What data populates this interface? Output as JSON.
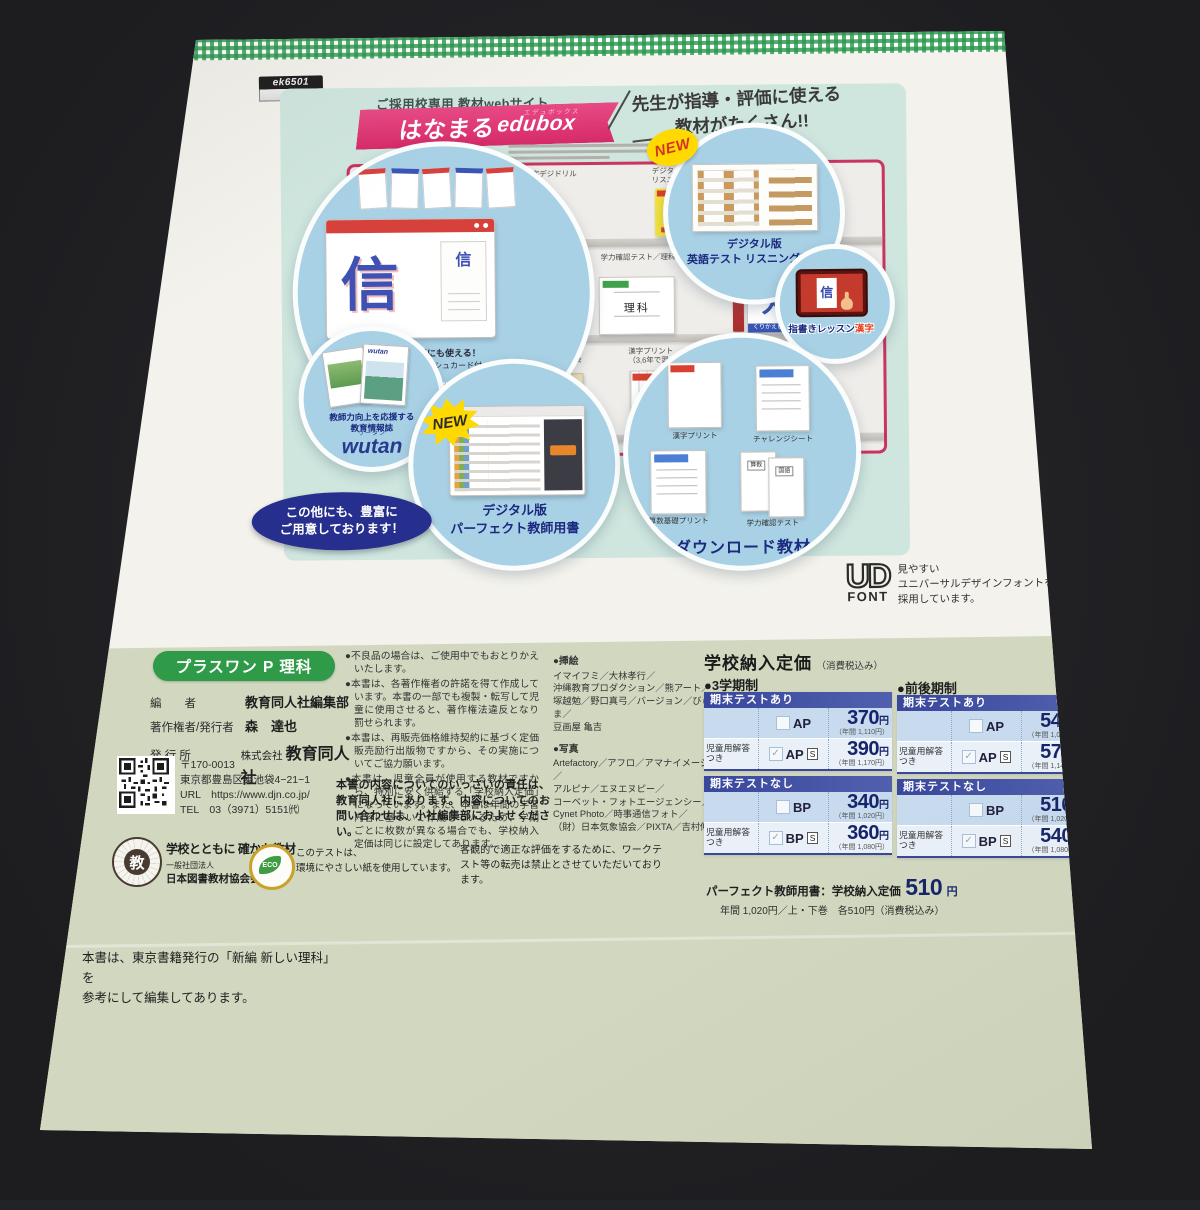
{
  "tag": {
    "code": "ek6501"
  },
  "ad": {
    "eyebrow": "ご採用校専用 教材webサイト",
    "banner_jp": "はなまる",
    "banner_en": "edubox",
    "banner_ruby": "エデュボックス",
    "catch_line1": "先生が指導・評価に使える",
    "catch_line2": "教材がたくさん!!",
    "shelf": {
      "row1_label1": "指導用 漢字デジドリル",
      "row1_label2": "デジタル版 英語テスト\nリスニング音声",
      "row2_label1": "漢字カード",
      "row2_label2": "学力確認テスト／理科",
      "row2_label3": "指書きレッスン漢字\nシリアルカード（くり漢）",
      "row3_label1": "デジタル版 算数テスト\nパーフェクト教師用書",
      "row3_label2": "チャレンジシート／社会",
      "row3_label3": "漢字プリント\n（3,6年で習った漢字）",
      "row3_label4": "算数基礎プリント",
      "book_english": "英語",
      "book_kan": "漢",
      "book_rika": "理科",
      "book_maru": "丸",
      "book_kurikaeshi": "くりかえし漢字ド",
      "book_sansu": "算数",
      "book_sansu_sub": "テスト"
    },
    "callout_kanji": {
      "glyph": "信",
      "glyph_small": "信",
      "caption1": "指導にも、家庭学習にも使える！",
      "caption2": "書き順アニメーションやフラッシュカード付",
      "title": "漢字デジドリル"
    },
    "callout_listening": {
      "new": "NEW",
      "title": "デジタル版\n英語テスト リスニング音声"
    },
    "callout_yubigaki": {
      "glyph": "信",
      "title_main": "指書きレッスン",
      "title_accent": "漢字"
    },
    "callout_wutan": {
      "caption1": "教師力向上を応援する",
      "caption2": "教育情報誌",
      "logo": "wutan",
      "ruby": "ウータン"
    },
    "callout_perfect": {
      "new": "NEW",
      "title": "デジタル版\nパーフェクト教師用書"
    },
    "callout_download": {
      "title": "ダウンロード教材",
      "item1": "漢字プリント",
      "item2": "チャレンジシート",
      "item3": "算数基礎プリント",
      "item4": "学力確認テスト",
      "doc_sansu": "算数",
      "doc_kokugo": "国語"
    },
    "more_oval": "この他にも、豊富に\nご用意しております！"
  },
  "udfont": {
    "logo_top": "UD",
    "logo_bottom": "FONT",
    "text": "見やすい\nユニバーサルデザインフォントを\n採用しています。"
  },
  "colophon": {
    "badge": "プラスワン P 理科",
    "credits": [
      {
        "label": "編　　者",
        "value": "教育同人社編集部"
      },
      {
        "label": "著作権者/発行者",
        "value": "森　達也"
      },
      {
        "label": "発 行 所",
        "value_prefix": "株式会社",
        "value": "教育同人社"
      }
    ],
    "postal": "〒170-0013",
    "address": "東京都豊島区東池袋4−21−1",
    "url": "URL　https://www.djn.co.jp/",
    "tel": "TEL　03（3971）5151㈹",
    "notes": [
      "●不良品の場合は、ご使用中でもおとりかえいたします。",
      "●本書は、各著作権者の許諾を得て作成しています。本書の一部でも複製・転写して児童に使用させると、著作権法違反となり罰せられます。",
      "●本書は、再販売価格維持契約に基づく定価販売励行出版物ですから、その実施についてご協力願います。",
      "●本書は、児童全員が使用する教材ですから、特別に安く供給する「学校納入定価」になっています。また、本書は年間の学習内容に基づいて作成しているため、学期ごとに枚数が異なる場合でも、学校納入定価は同じに設定してあります。"
    ],
    "responsibility": "本書の内容についてのいっさいの責任は、教育同人社にあります。内容についてのお問い合わせは、小社編集部におよせください。",
    "illust_heading": "●挿絵",
    "illust_body": "イマイフミ／大林孝行／\n沖縄教育プロダクション／熊アート／\n塚越勉／野口真弓／バージョン／びゅーま／\n豆画屋 亀吉",
    "photo_heading": "●写真",
    "photo_body": "Artefactory／アフロ／アマナイメージズ／\nアルピナ／エヌエヌピー／\nコーベット・フォトエージェンシー／\nCynet Photo／時事通信フォト／\n（財）日本気象協会／PIXTA／吉村伸一"
  },
  "pricing": {
    "title": "学校納入定価",
    "title_note": "（消費税込み）",
    "left_system": "●3学期制",
    "right_system": "●前後期制",
    "header_with": "期末テストあり",
    "header_without": "期末テストなし",
    "row_label_answer": "児童用解答つき",
    "s_mark": "S",
    "yen": "円",
    "check": "✓",
    "left": {
      "with": [
        {
          "code": "AP",
          "price": "370",
          "annual": "（年間 1,110円）"
        },
        {
          "code": "AP",
          "price": "390",
          "annual": "（年間 1,170円）"
        }
      ],
      "without": [
        {
          "code": "BP",
          "price": "340",
          "annual": "（年間 1,020円）"
        },
        {
          "code": "BP",
          "price": "360",
          "annual": "（年間 1,080円）"
        }
      ]
    },
    "right": {
      "with": [
        {
          "code": "AP",
          "price": "540",
          "annual": "（年間 1,080円）"
        },
        {
          "code": "AP",
          "price": "570",
          "annual": "（年間 1,140円）"
        }
      ],
      "without": [
        {
          "code": "BP",
          "price": "510",
          "annual": "（年間 1,020円）"
        },
        {
          "code": "BP",
          "price": "540",
          "annual": "（年間 1,080円）"
        }
      ]
    },
    "teacher_label": "パーフェクト教師用書：学校納入定価",
    "teacher_price": "510",
    "teacher_note": "年間 1,020円／上・下巻　各510円（消費税込み）"
  },
  "footer": {
    "stamp": "教",
    "assoc_line1": "学校とともに 確かな教材",
    "assoc_line2": "一般社団法人",
    "assoc_line3": "日本図書教材協会会員",
    "eco_label": "ECO",
    "eco_text": "このテストは、\n環境にやさしい紙を使用しています。",
    "resale": "客観的で適正な評価をするために、ワークテスト等の転売は禁止とさせていただいております。",
    "reference": "本書は、東京書籍発行の「新編 新しい理科」を\n参考にして編集してあります。"
  }
}
